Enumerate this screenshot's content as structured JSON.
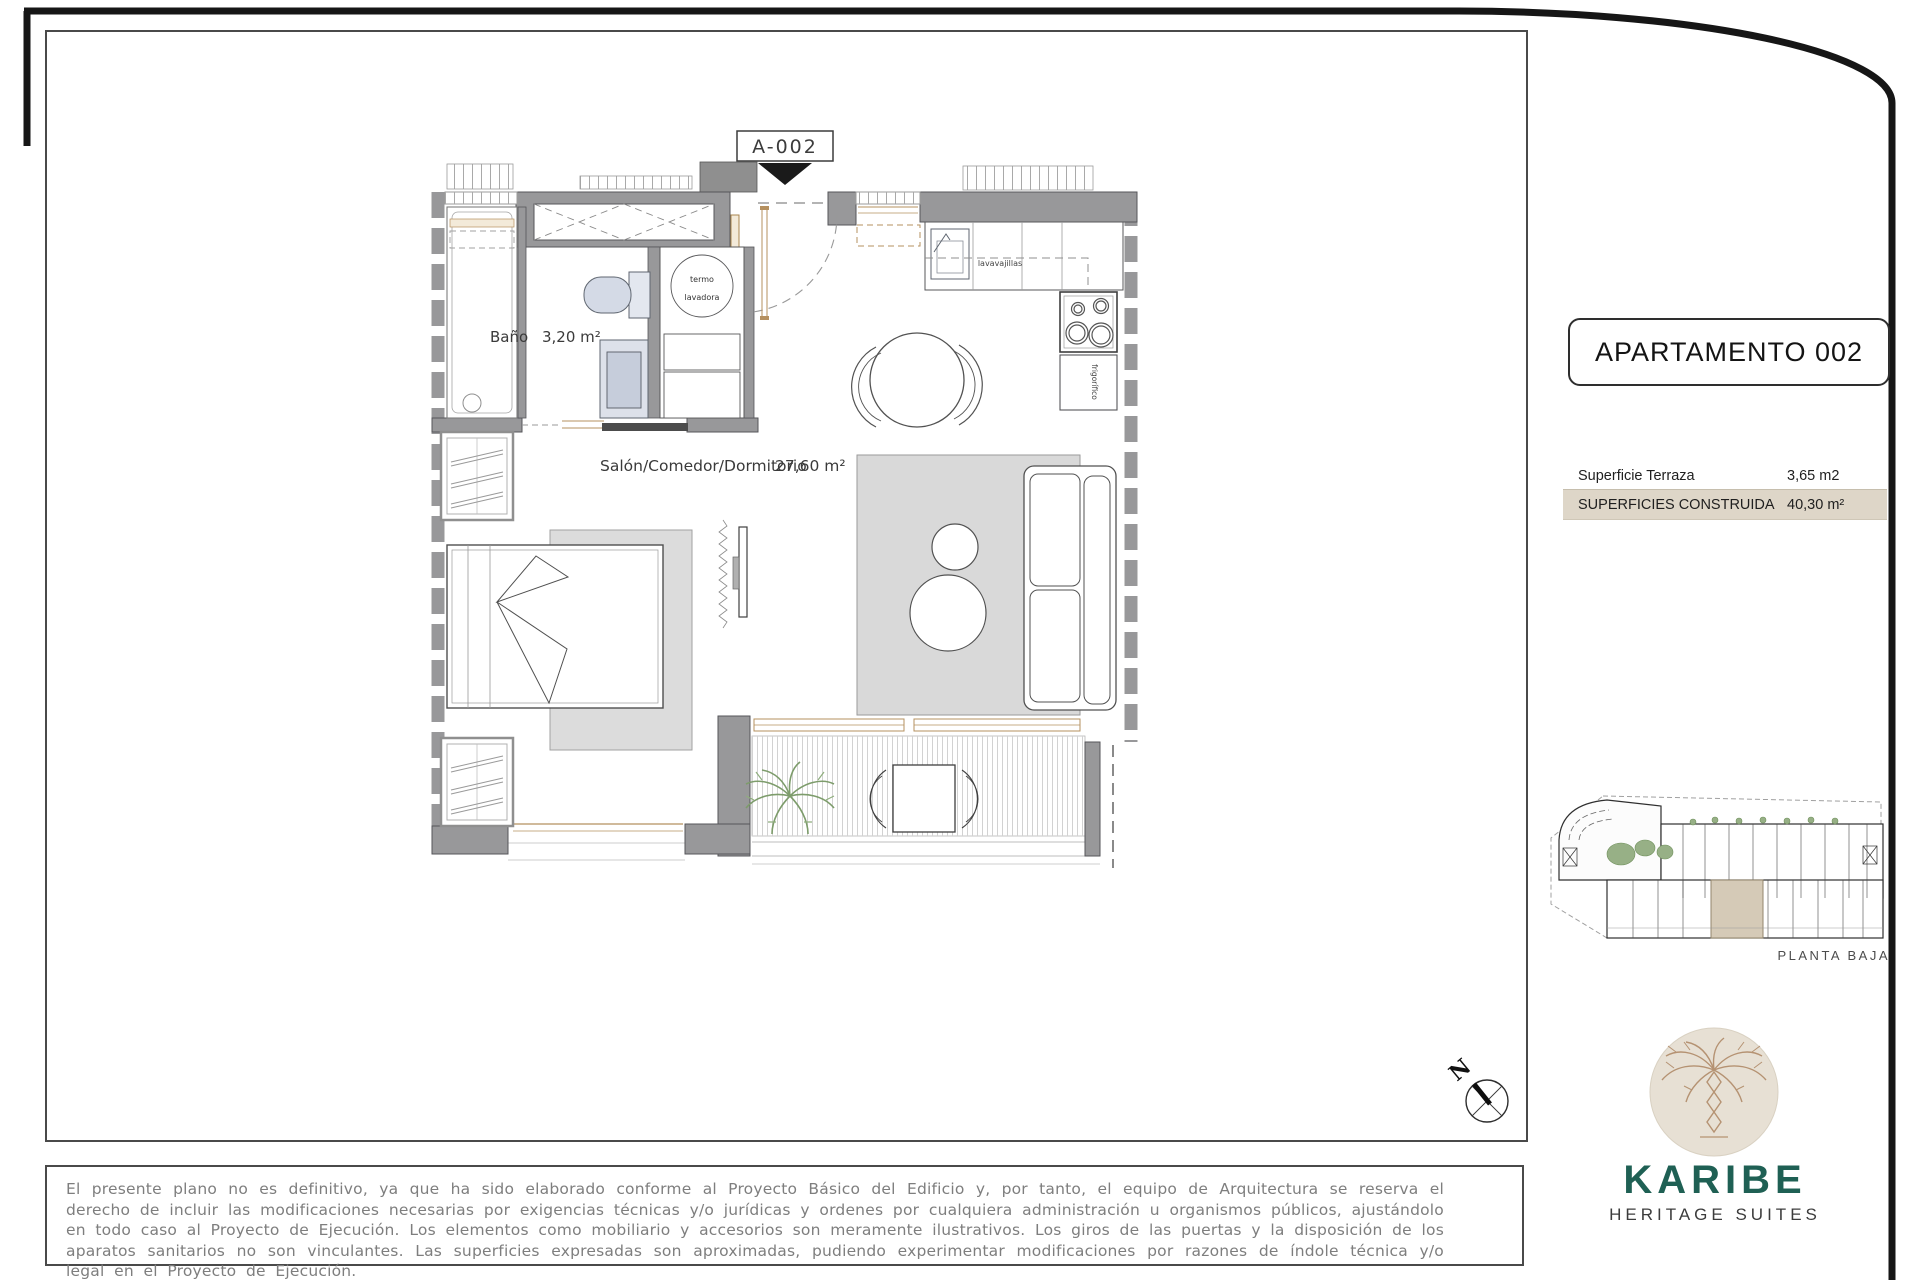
{
  "plan": {
    "callout": "A-002",
    "bath": {
      "name": "Baño",
      "area": "3,20 m²"
    },
    "living": {
      "name": "Salón/Comedor/Dormitorio",
      "area": "27,60 m²"
    },
    "labels": {
      "termo": "termo",
      "lavadora": "lavadora",
      "lavavajillas": "lavavajillas",
      "frigorifico": "frigorífico"
    }
  },
  "panel": {
    "title": "APARTAMENTO 002",
    "surfaces": [
      {
        "label": "Superficie Terraza",
        "value": "3,65 m2"
      },
      {
        "label": "SUPERFICIES CONSTRUIDA",
        "value": "40,30 m²"
      }
    ],
    "floor_label": "PLANTA BAJA"
  },
  "compass": {
    "north": "N"
  },
  "brand": {
    "name": "KARIBE",
    "tagline": "HERITAGE SUITES"
  },
  "disclaimer": {
    "text": "El presente plano no es definitivo, ya que ha sido elaborado conforme al Proyecto Básico del Edificio y, por tanto, el equipo de Arquitectura se reserva el derecho de incluir las modificaciones necesarias por exigencias técnicas y/o jurídicas y ordenes por cualquiera administración u organismos públicos, ajustándolo en todo caso al Proyecto de Ejecución. Los elementos como mobiliario y accesorios son meramente ilustrativos. Los giros de las puertas y la disposición de los aparatos sanitarios no son vinculantes. Las superficies expresadas son aproximadas, pudiendo experimentar modificaciones por razones de índole técnica y/o legal en el Proyecto de Ejecución."
  },
  "colors": {
    "brand_teal": "#1f6054",
    "highlight_row": "#ded6c8",
    "wall_gray": "#98989a",
    "wood_tan": "#b5905f",
    "plant_green": "#7d9c6b"
  }
}
